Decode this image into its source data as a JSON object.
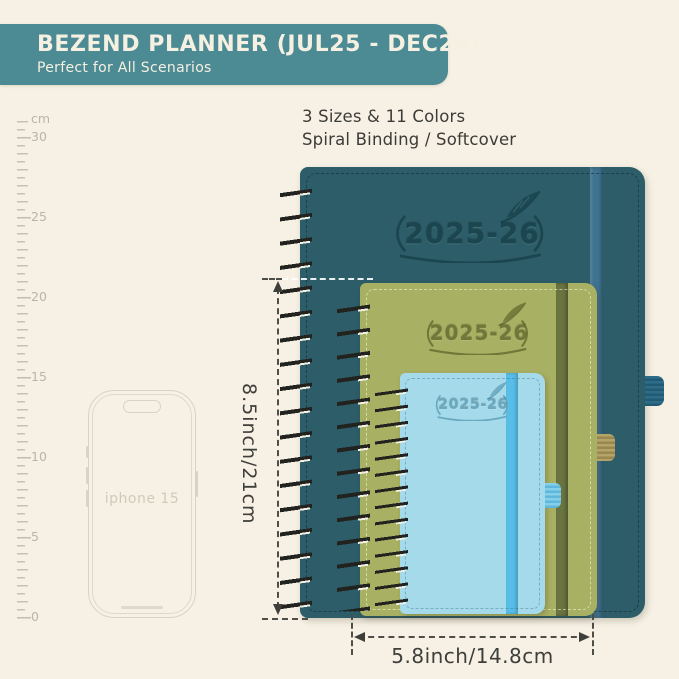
{
  "page": {
    "background_color": "#f6f1e4"
  },
  "header": {
    "title": "BEZEND PLANNER (JUL25 - DEC26)",
    "subtitle": "Perfect for All Scenarios",
    "background_color": "#4c8b94",
    "text_color": "#f5f0e2"
  },
  "features": {
    "line1": "3 Sizes & 11 Colors",
    "line2": "Spiral Binding / Softcover"
  },
  "ruler": {
    "unit": "cm",
    "tick_labels": [
      "30",
      "25",
      "20",
      "15",
      "10",
      "5",
      "0"
    ]
  },
  "phone": {
    "label": "iphone 15"
  },
  "planners": {
    "large": {
      "year": "2025-26",
      "cover_color": "#2c5d68",
      "band_color": "#3f7390",
      "emboss_color": "#1b4650"
    },
    "medium": {
      "year": "2025-26",
      "cover_color": "#a8b063",
      "band_color": "#6a7440",
      "emboss_color": "#6f7838"
    },
    "small": {
      "year": "2025-26",
      "cover_color": "#a5daea",
      "band_color": "#58bee8",
      "emboss_color": "#69a9c0"
    }
  },
  "dimensions": {
    "height_label": "8.5inch/21cm",
    "width_label": "5.8inch/14.8cm"
  }
}
